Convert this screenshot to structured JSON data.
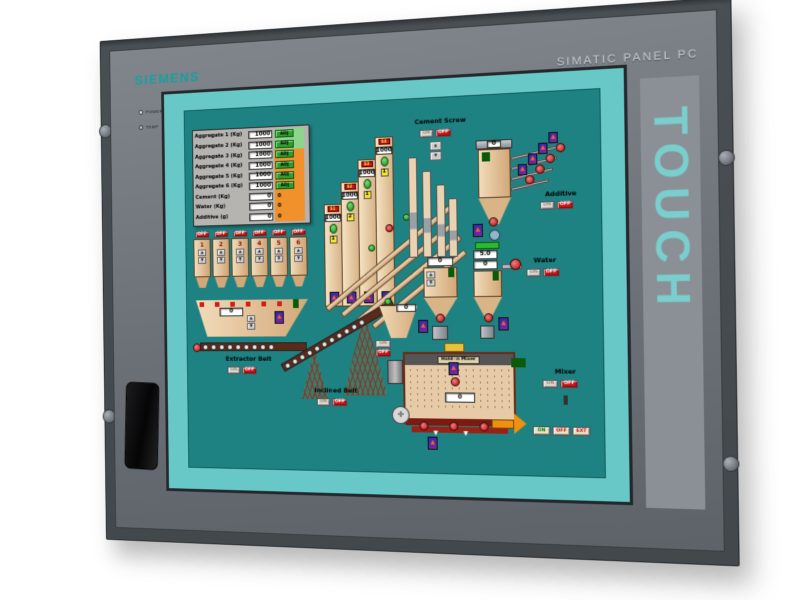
{
  "panel": {
    "brand": "SIEMENS",
    "model": "SIMATIC PANEL PC",
    "touch": "TOUCH",
    "leds": [
      {
        "label": "POWER"
      },
      {
        "label": "TEMP"
      }
    ]
  },
  "icons": {
    "up": "▲",
    "down": "▼",
    "flame": "▲",
    "fan": "✛",
    "down_arrow": "▼"
  },
  "hmi": {
    "recipe": {
      "rows": [
        {
          "label": "Aggregate 1 (Kg)",
          "value": "1000",
          "action": "ADJ"
        },
        {
          "label": "Aggregate 2 (Kg)",
          "value": "1000",
          "action": "ADJ"
        },
        {
          "label": "Aggregate 3 (Kg)",
          "value": "1000",
          "action": "ADJ"
        },
        {
          "label": "Aggregate 4 (Kg)",
          "value": "1000",
          "action": "ADJ"
        },
        {
          "label": "Aggregate 5 (Kg)",
          "value": "1000",
          "action": "ADJ"
        },
        {
          "label": "Aggregate 6 (Kg)",
          "value": "1000",
          "action": "ADJ"
        },
        {
          "label": "Cement (Kg)",
          "value": "0",
          "action": "0"
        },
        {
          "label": "Water (Kg)",
          "value": "0",
          "action": "0"
        },
        {
          "label": "Additive (g)",
          "value": "0",
          "action": "0"
        }
      ]
    },
    "bins": {
      "off": "OFF",
      "numbers": [
        "1",
        "2",
        "3",
        "4",
        "5",
        "6"
      ]
    },
    "silos": [
      {
        "tag": "S1",
        "value": "1000",
        "badge": "1"
      },
      {
        "tag": "S2",
        "value": "1000",
        "badge": "2"
      },
      {
        "tag": "S3",
        "value": "1000",
        "badge": "1"
      },
      {
        "tag": "S4",
        "value": "1000",
        "badge": "1"
      }
    ],
    "cement_screw": {
      "label": "Cement Screw",
      "on": "ON",
      "off": "OFF"
    },
    "cement_hopper": {
      "value": "0"
    },
    "water": {
      "label": "Water",
      "on": "ON",
      "off": "OFF",
      "setpoint": "5.0",
      "hopper_value": "0"
    },
    "additive": {
      "label": "Additive",
      "on": "ON",
      "off": "OFF",
      "hopper_value": "0"
    },
    "extractor_belt": {
      "label": "Extractor Belt",
      "on": "ON",
      "off": "OFF",
      "hopper_value": "0"
    },
    "inclined_belt": {
      "label": "Inclined Belt",
      "on": "ON",
      "off": "OFF"
    },
    "hold_hopper": {
      "value": "0",
      "on": "ON",
      "off": "OFF"
    },
    "mixer": {
      "label": "Mixer",
      "on": "ON",
      "off": "OFF",
      "banner": "Hold in Mixer",
      "value": "0",
      "discharge_on": "ON",
      "discharge_off": "OFF",
      "discharge_ext": "EXT"
    },
    "colors": {
      "screen_bg": "#1F8282",
      "surround": "#68C8C8",
      "brand_teal": "#18A0A0",
      "alarm_red": "#C81414",
      "ok_green": "#2DB82D",
      "warn_orange": "#F0912C"
    }
  }
}
